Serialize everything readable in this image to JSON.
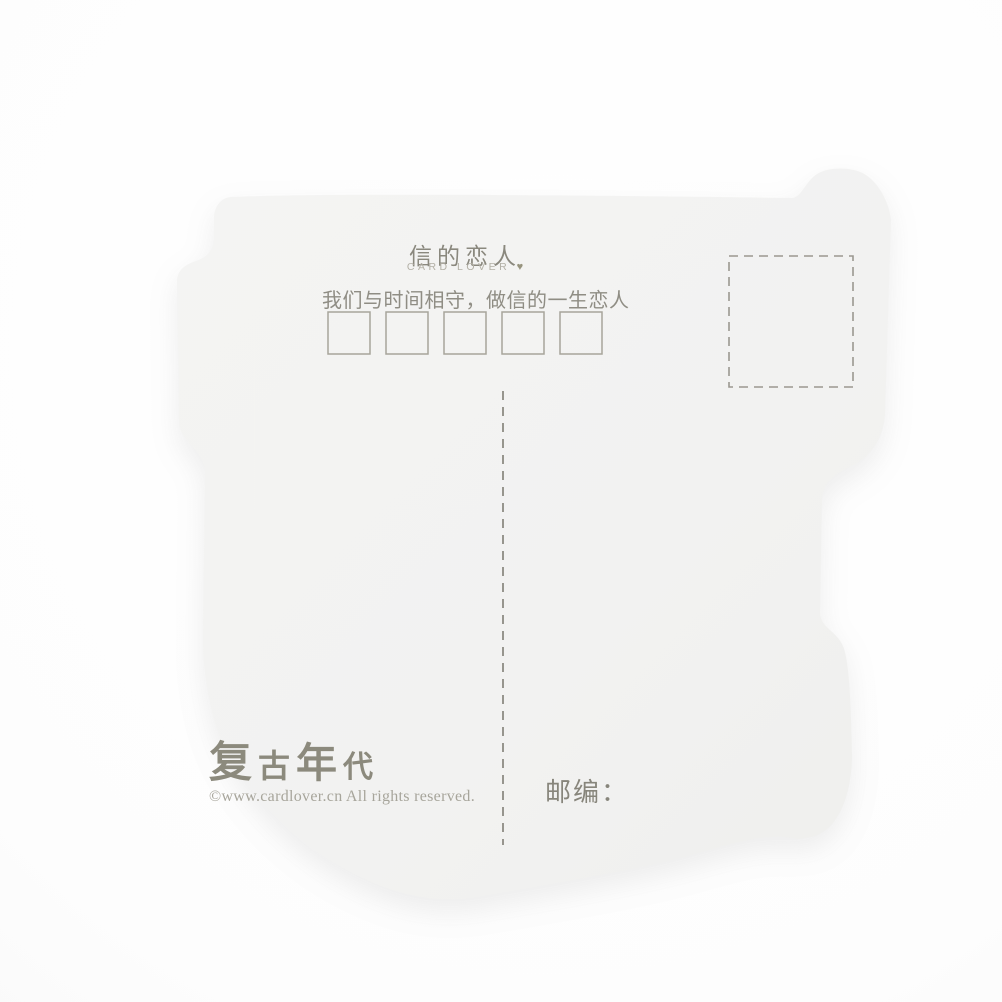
{
  "postcard": {
    "header": {
      "title": "信的恋人",
      "subtitle_en": "CARD LOVER",
      "heart_icon": "♥",
      "tagline": "我们与时间相守，做信的一生恋人"
    },
    "postal_code_boxes": 5,
    "postal_label": "邮编：",
    "brand": {
      "logo_chars": [
        "复",
        "古",
        "年",
        "代"
      ],
      "copyright": "©www.cardlover.cn All rights reserved."
    },
    "colors": {
      "background": "#fdfdfd",
      "card": "#f2f2f1",
      "ink": "#8a887e",
      "ink_light": "#b3b0a6",
      "line": "#8d8b83",
      "box_border": "#a7a59b"
    }
  }
}
